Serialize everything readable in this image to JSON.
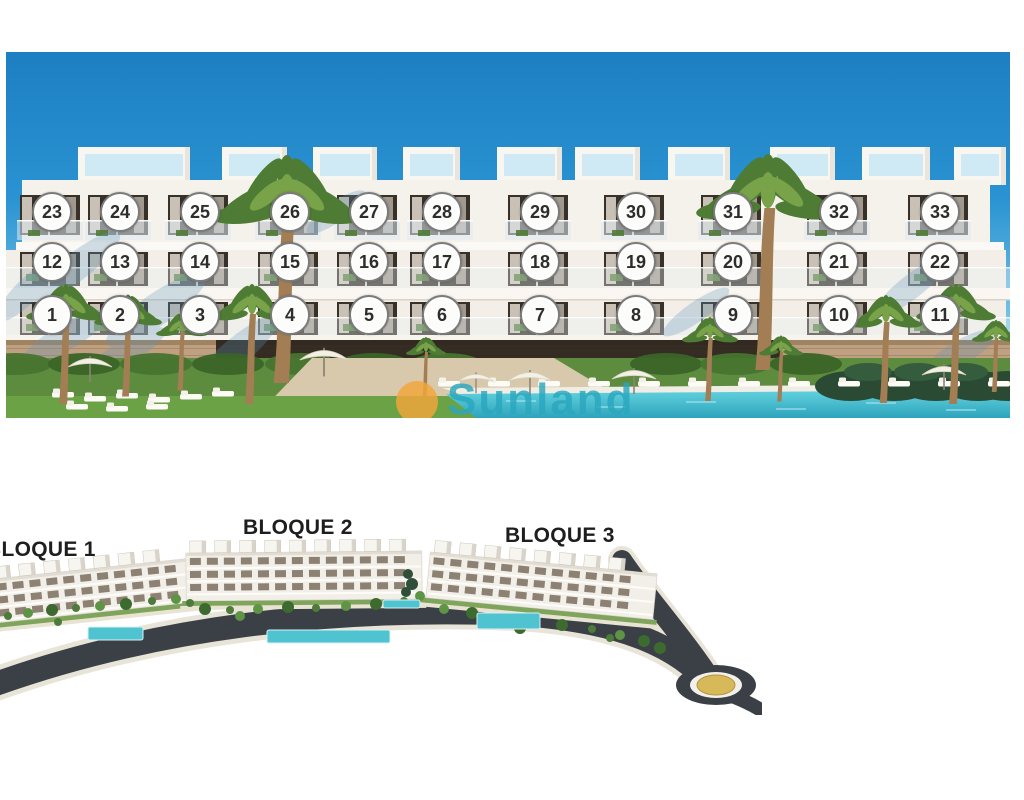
{
  "facade_view": {
    "floors": [
      {
        "name": "third-floor",
        "units": [
          "23",
          "24",
          "25",
          "26",
          "27",
          "28",
          "29",
          "30",
          "31",
          "32",
          "33"
        ]
      },
      {
        "name": "second-floor",
        "units": [
          "12",
          "13",
          "14",
          "15",
          "16",
          "17",
          "18",
          "19",
          "20",
          "21",
          "22"
        ]
      },
      {
        "name": "first-floor",
        "units": [
          "1",
          "2",
          "3",
          "4",
          "5",
          "6",
          "7",
          "8",
          "9",
          "10",
          "11"
        ]
      }
    ],
    "watermark": {
      "text": "Sunland",
      "logo_color": "#f3a73b",
      "text_color": "#2aa7bd"
    },
    "colors": {
      "sky": "#2189cc",
      "pool": "#3fb6c9",
      "grass": "#5e8c3f",
      "stone_base": "#bfa080"
    }
  },
  "site_view": {
    "blocks": [
      {
        "label": "BLOQUE 1"
      },
      {
        "label": "BLOQUE 2"
      },
      {
        "label": "BLOQUE 3"
      }
    ],
    "colors": {
      "road": "#3a4045",
      "roundabout_center": "#d8b95a"
    }
  }
}
